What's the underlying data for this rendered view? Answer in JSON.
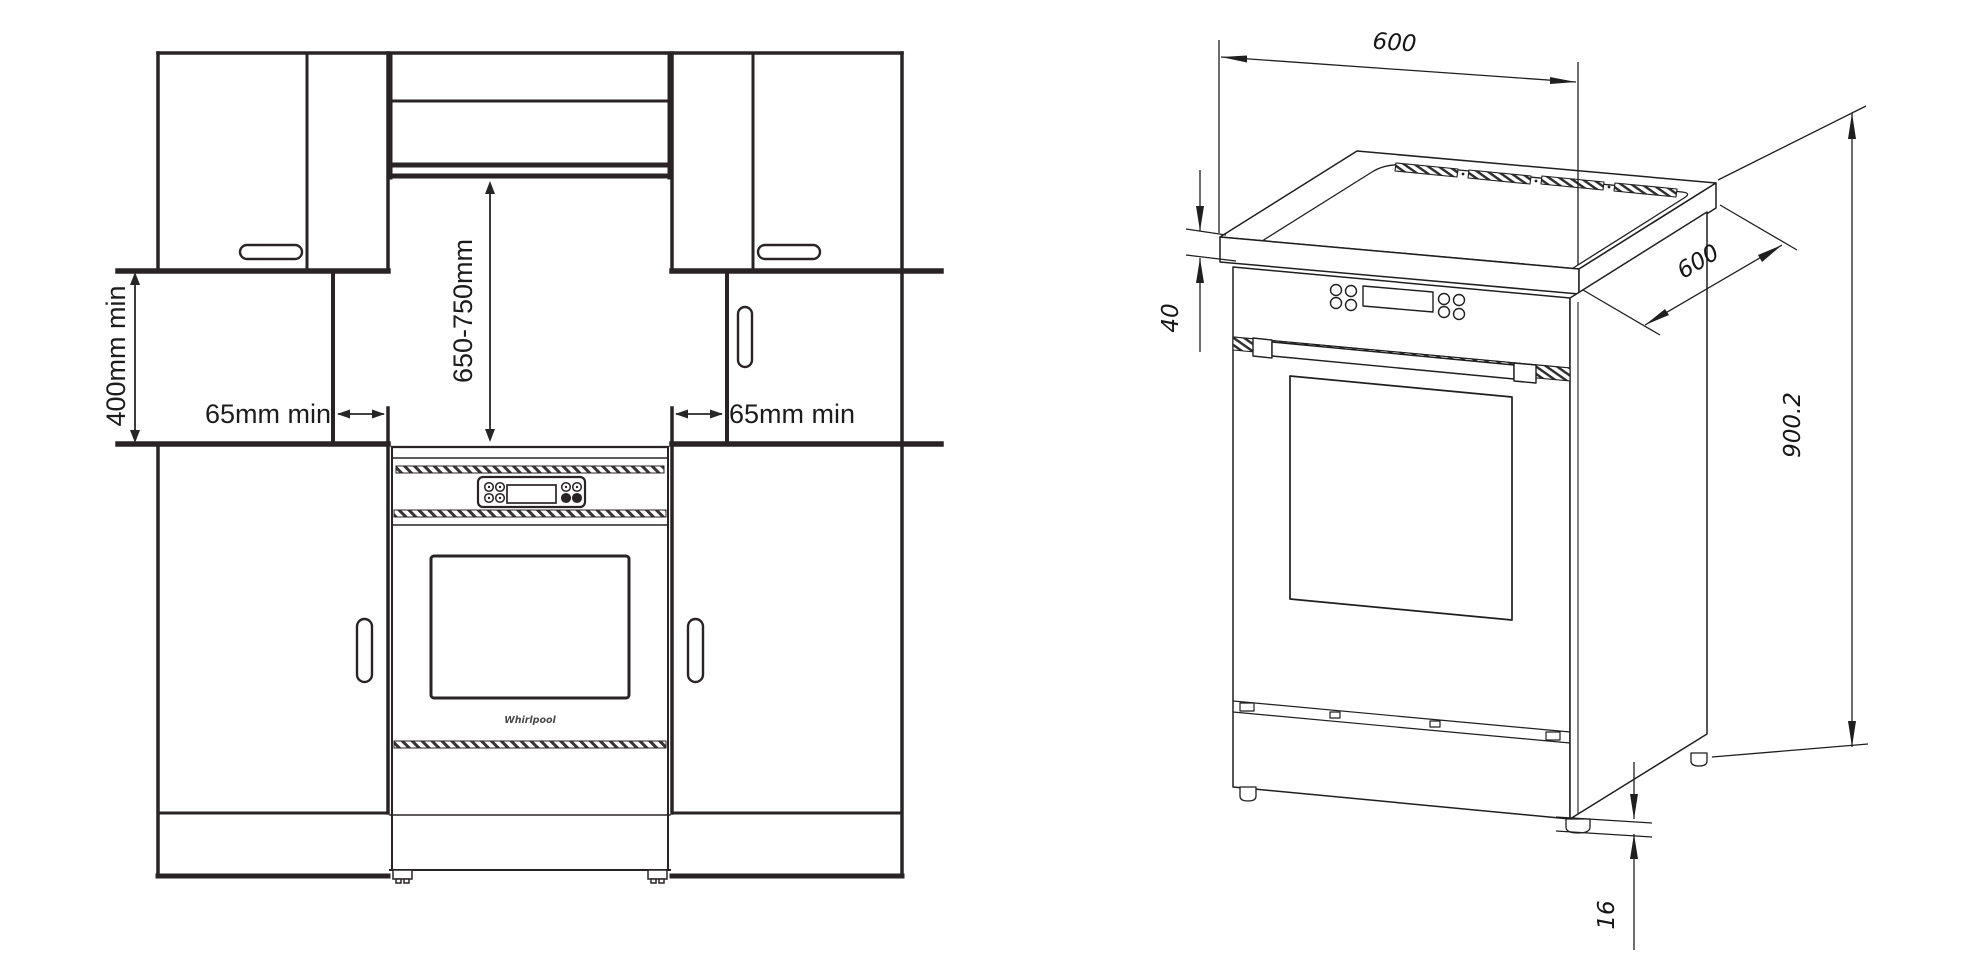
{
  "colors": {
    "line_front_view": "#2a2326",
    "line_iso_view": "#1f1f1f",
    "dimension_text": "#1c1c1c",
    "background": "#ffffff"
  },
  "left_diagram": {
    "type": "installation-clearances-front-view",
    "labels": {
      "side_clearance": "400mm min",
      "hood_clearance": "650-750mm",
      "gap_left": "65mm min",
      "gap_right": "65mm min",
      "brand": "Whirlpool"
    }
  },
  "right_diagram": {
    "type": "cooker-isometric-dimensions",
    "labels": {
      "width_mm": "600",
      "depth_mm": "600",
      "height_mm": "900.2",
      "worktop_edge_mm": "40",
      "foot_height_mm": "16"
    }
  }
}
